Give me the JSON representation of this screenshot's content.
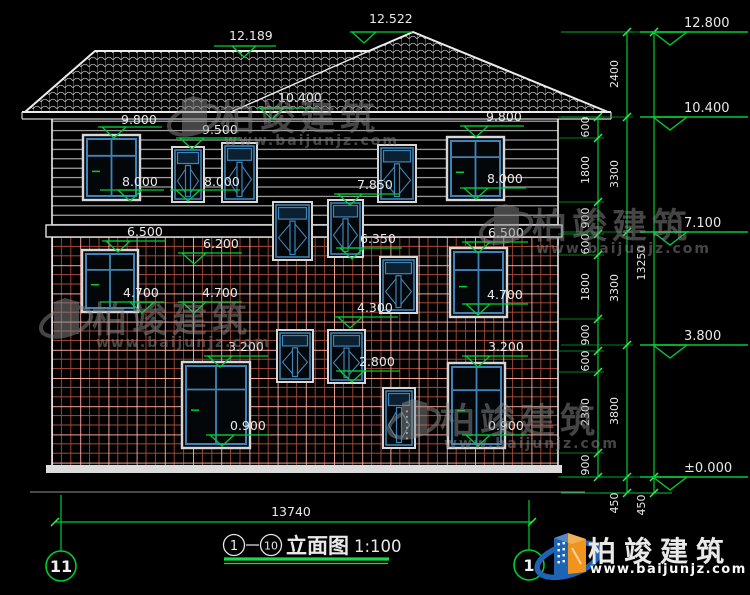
{
  "colors": {
    "background": "#000000",
    "dim_green": "#00cc33",
    "window_blue": "#3d85b8",
    "line_white": "#ececec",
    "tile_red": "#a64b38",
    "logo_blue": "#1e63b4",
    "logo_orange": "#f0941d"
  },
  "title_bar": {
    "axis_from": "1",
    "axis_to": "10",
    "dash": "—",
    "name": "立面图",
    "scale": "1:100"
  },
  "grid_bubbles": {
    "left": "11",
    "right": "1"
  },
  "bottom_dimension": {
    "label": "13740"
  },
  "overall_dimension": {
    "label": "13250"
  },
  "watermark": {
    "brand": "柏竣建筑",
    "url": "www.baijunjz.com"
  },
  "footer_logo": {
    "brand": "柏竣建筑",
    "url": "www.baijunjz.com"
  },
  "elevation_markers": [
    {
      "label": "12.522",
      "x1": 350,
      "x2": 412,
      "y": 32,
      "tx": 364,
      "lx": 369,
      "ly": 23
    },
    {
      "label": "12.189",
      "x1": 214,
      "x2": 276,
      "y": 46,
      "tx": 244,
      "lx": 229,
      "ly": 40
    },
    {
      "label": "10.400",
      "x1": 256,
      "x2": 318,
      "y": 108,
      "tx": 272,
      "lx": 278,
      "ly": 102
    },
    {
      "label": "9.800",
      "x1": 98,
      "x2": 162,
      "y": 127,
      "tx": 114,
      "lx": 121,
      "ly": 124
    },
    {
      "label": "9.500",
      "x1": 176,
      "x2": 240,
      "y": 138,
      "tx": 192,
      "lx": 202,
      "ly": 134
    },
    {
      "label": "9.800",
      "x1": 460,
      "x2": 524,
      "y": 126,
      "tx": 476,
      "lx": 486,
      "ly": 121
    },
    {
      "label": "8.000",
      "x1": 100,
      "x2": 164,
      "y": 190,
      "tx": 130,
      "lx": 122,
      "ly": 186
    },
    {
      "label": "8.000",
      "x1": 170,
      "x2": 240,
      "y": 190,
      "tx": 188,
      "lx": 204,
      "ly": 186
    },
    {
      "label": "8.000",
      "x1": 460,
      "x2": 526,
      "y": 188,
      "tx": 476,
      "lx": 487,
      "ly": 183
    },
    {
      "label": "7.850",
      "x1": 334,
      "x2": 400,
      "y": 194,
      "tx": 350,
      "lx": 357,
      "ly": 189
    },
    {
      "label": "6.500",
      "x1": 102,
      "x2": 166,
      "y": 241,
      "tx": 118,
      "lx": 127,
      "ly": 236
    },
    {
      "label": "6.500",
      "x1": 462,
      "x2": 528,
      "y": 242,
      "tx": 478,
      "lx": 488,
      "ly": 237
    },
    {
      "label": "6.350",
      "x1": 336,
      "x2": 402,
      "y": 248,
      "tx": 352,
      "lx": 360,
      "ly": 243
    },
    {
      "label": "6.200",
      "x1": 178,
      "x2": 242,
      "y": 253,
      "tx": 194,
      "lx": 203,
      "ly": 248
    },
    {
      "label": "4.700",
      "x1": 100,
      "x2": 164,
      "y": 302,
      "tx": 142,
      "lx": 123,
      "ly": 297
    },
    {
      "label": "4.700",
      "x1": 178,
      "x2": 242,
      "y": 302,
      "tx": 194,
      "lx": 202,
      "ly": 297
    },
    {
      "label": "4.700",
      "x1": 462,
      "x2": 528,
      "y": 304,
      "tx": 478,
      "lx": 487,
      "ly": 299
    },
    {
      "label": "4.300",
      "x1": 334,
      "x2": 398,
      "y": 317,
      "tx": 350,
      "lx": 357,
      "ly": 312
    },
    {
      "label": "3.200",
      "x1": 204,
      "x2": 268,
      "y": 356,
      "tx": 220,
      "lx": 228,
      "ly": 351
    },
    {
      "label": "3.200",
      "x1": 462,
      "x2": 528,
      "y": 356,
      "tx": 478,
      "lx": 488,
      "ly": 351
    },
    {
      "label": "2.800",
      "x1": 336,
      "x2": 400,
      "y": 371,
      "tx": 352,
      "lx": 359,
      "ly": 366
    },
    {
      "label": "0.900",
      "x1": 206,
      "x2": 270,
      "y": 435,
      "tx": 222,
      "lx": 230,
      "ly": 430
    },
    {
      "label": "0.900",
      "x1": 462,
      "x2": 528,
      "y": 435,
      "tx": 478,
      "lx": 488,
      "ly": 430
    }
  ],
  "right_elevation_markers": [
    {
      "label": "12.800",
      "y": 32
    },
    {
      "label": "10.400",
      "y": 117
    },
    {
      "label": "7.100",
      "y": 232
    },
    {
      "label": "3.800",
      "y": 345
    },
    {
      "label": "±0.000",
      "y": 477
    }
  ],
  "dim_chains": [
    {
      "x": 598,
      "ext": 40,
      "ticks": [
        117,
        138,
        202,
        234,
        255,
        319,
        351,
        372,
        453,
        477
      ],
      "labels": [
        {
          "t": "600",
          "y": 127
        },
        {
          "t": "1800",
          "y": 170
        },
        {
          "t": "900",
          "y": 218
        },
        {
          "t": "600",
          "y": 244
        },
        {
          "t": "1800",
          "y": 287
        },
        {
          "t": "900",
          "y": 335
        },
        {
          "t": "600",
          "y": 361
        },
        {
          "t": "2300",
          "y": 412
        },
        {
          "t": "900",
          "y": 465
        }
      ]
    },
    {
      "x": 627,
      "ext": 66,
      "ticks": [
        32,
        117,
        232,
        345,
        477,
        493
      ],
      "labels": [
        {
          "t": "2400",
          "y": 74
        },
        {
          "t": "3300",
          "y": 174
        },
        {
          "t": "3300",
          "y": 288
        },
        {
          "t": "3800",
          "y": 411
        },
        {
          "t": "450",
          "y": 503
        }
      ]
    },
    {
      "x": 654,
      "ext": 93,
      "ticks": [
        32,
        477,
        493
      ],
      "labels": [
        {
          "t": "13250",
          "y": 263
        },
        {
          "t": "450",
          "y": 505
        }
      ]
    }
  ],
  "bottom_dim_line": {
    "y": 522,
    "x1": 55,
    "x2": 532,
    "label_x": 291,
    "label_y": 516
  },
  "axes": [
    {
      "bubble": "11",
      "cx": 61,
      "cy": 566,
      "ext_top": 495
    },
    {
      "bubble": "1",
      "cx": 529,
      "cy": 565,
      "ext_top": 500
    }
  ],
  "windows": [
    {
      "x": 83,
      "y": 135,
      "w": 57,
      "h": 65,
      "type": "big"
    },
    {
      "x": 447,
      "y": 137,
      "w": 57,
      "h": 63,
      "type": "big"
    },
    {
      "x": 172,
      "y": 147,
      "w": 32,
      "h": 55,
      "type": "cas"
    },
    {
      "x": 222,
      "y": 143,
      "w": 35,
      "h": 59,
      "type": "cas"
    },
    {
      "x": 378,
      "y": 145,
      "w": 38,
      "h": 57,
      "type": "cas"
    },
    {
      "x": 273,
      "y": 202,
      "w": 39,
      "h": 58,
      "type": "cas"
    },
    {
      "x": 328,
      "y": 200,
      "w": 35,
      "h": 57,
      "type": "cas"
    },
    {
      "x": 380,
      "y": 257,
      "w": 37,
      "h": 56,
      "type": "cas"
    },
    {
      "x": 82,
      "y": 250,
      "w": 56,
      "h": 62,
      "type": "big"
    },
    {
      "x": 450,
      "y": 248,
      "w": 57,
      "h": 69,
      "type": "big"
    },
    {
      "x": 277,
      "y": 330,
      "w": 36,
      "h": 52,
      "type": "cas"
    },
    {
      "x": 328,
      "y": 330,
      "w": 37,
      "h": 53,
      "type": "cas"
    },
    {
      "x": 182,
      "y": 362,
      "w": 68,
      "h": 86,
      "type": "big"
    },
    {
      "x": 448,
      "y": 363,
      "w": 57,
      "h": 85,
      "type": "big"
    },
    {
      "x": 383,
      "y": 388,
      "w": 32,
      "h": 60,
      "type": "door"
    }
  ],
  "watermarks": [
    {
      "x": 168,
      "y": 88
    },
    {
      "x": 480,
      "y": 196
    },
    {
      "x": 40,
      "y": 290
    },
    {
      "x": 388,
      "y": 391
    }
  ]
}
